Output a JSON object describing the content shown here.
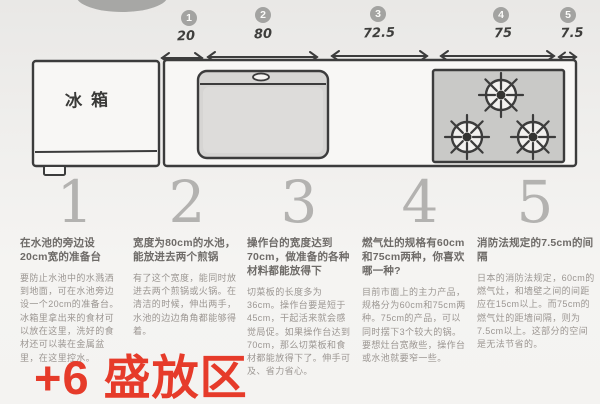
{
  "page": {
    "background": "#f2f1ef",
    "accent_red": "#e63b2a"
  },
  "scale": {
    "steps": [
      {
        "num": "1",
        "value": "20"
      },
      {
        "num": "2",
        "value": "80"
      },
      {
        "num": "3",
        "value": "72.5"
      },
      {
        "num": "4",
        "value": "75"
      },
      {
        "num": "5",
        "value": "7.5"
      }
    ]
  },
  "diagram": {
    "fridge_label": "冰箱"
  },
  "sections": [
    {
      "number": "1",
      "heading": "在水池的旁边设20cm宽的准备台",
      "body": "要防止水池中的水溅洒到地面，可在水池旁边设一个20cm的准备台。冰箱里拿出来的食材可以放在这里，洗好的食材还可以装在金属盆里，在这里控水。"
    },
    {
      "number": "2",
      "heading": "宽度为80cm的水池，能放进去两个煎锅",
      "body": "有了这个宽度，能同时放进去两个煎锅或火锅。在清洁的时候，伸出两手，水池的边边角角都能够得着。"
    },
    {
      "number": "3",
      "heading": "操作台的宽度达到70cm，做准备的各种材料都能放得下",
      "body": "切菜板的长度多为36cm。操作台要是短于45cm，干起活来就会感觉局促。如果操作台达到70cm，那么切菜板和食材都能放得下了。伸手可及、省力省心。"
    },
    {
      "number": "4",
      "heading": "燃气灶的规格有60cm和75cm两种，你喜欢哪一种?",
      "body": "目前市面上的主力产品，规格分为60cm和75cm两种。75cm的产品，可以同时摆下3个较大的锅。要想灶台宽敞些，操作台或水池就要窄一些。"
    },
    {
      "number": "5",
      "heading": "消防法规定的7.5cm的间隔",
      "body": "日本的消防法规定，60cm的燃气灶，和墙壁之间的间距应在15cm以上。而75cm的燃气灶的距墙间隔，则为7.5cm以上。这部分的空间是无法节省的。"
    }
  ],
  "annotation": {
    "text": "+6 盛放区"
  }
}
